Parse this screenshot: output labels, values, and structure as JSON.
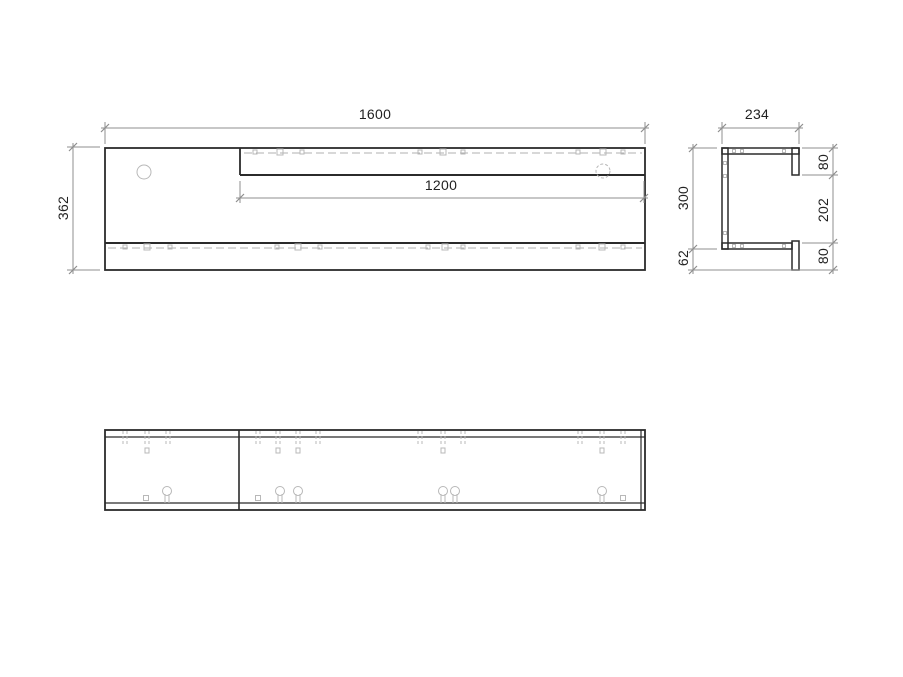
{
  "drawing_title": "furniture-panel-technical-drawing",
  "dimensions": {
    "front_width": {
      "value": "1600"
    },
    "shelf_length": {
      "value": "1200"
    },
    "front_height": {
      "value": "362"
    },
    "side_depth": {
      "value": "234"
    },
    "side_back_height": {
      "value": "300"
    },
    "side_bottom_drop": {
      "value": "62"
    },
    "side_top_lip": {
      "value": "80"
    },
    "side_opening": {
      "value": "202"
    },
    "side_bottom_lip": {
      "value": "80"
    }
  },
  "style": {
    "outline": "#2b2b2b",
    "dim": "#8f8f8f",
    "hidden": "#b0b0b0",
    "symbol": "#b8b8b8",
    "text": "#222222",
    "background": "#ffffff"
  },
  "shapes": [
    {
      "t": "rect",
      "x": 105,
      "y": 148,
      "w": 540,
      "h": 122,
      "sw": 1.8,
      "n": "front-view-outline"
    },
    {
      "t": "line",
      "x1": 240,
      "y1": 148,
      "x2": 240,
      "y2": 175,
      "w": 1.8,
      "n": "front-shelf-left-edge"
    },
    {
      "t": "line",
      "x1": 240,
      "y1": 175,
      "x2": 645,
      "y2": 175,
      "w": 2,
      "n": "front-shelf-bottom-edge"
    },
    {
      "t": "line",
      "x1": 105,
      "y1": 243,
      "x2": 645,
      "y2": 243,
      "w": 2,
      "n": "front-bottom-lip-top-edge"
    },
    {
      "t": "line",
      "x1": 244,
      "y1": 153,
      "x2": 642,
      "y2": 153,
      "w": 1,
      "c": "hidden",
      "dash": "8,4",
      "n": "front-shelf-hidden-line"
    },
    {
      "t": "line",
      "x1": 108,
      "y1": 248,
      "x2": 642,
      "y2": 248,
      "w": 1,
      "c": "hidden",
      "dash": "8,4",
      "n": "front-bottom-hidden-line"
    },
    {
      "t": "circle",
      "x": 144,
      "y": 172,
      "r": 7,
      "c": "sym",
      "n": "front-hole"
    },
    {
      "t": "circle",
      "x": 603,
      "y": 171,
      "r": 7,
      "c": "sym",
      "dash": "3,2",
      "n": "front-hidden-hole"
    },
    {
      "t": "sq",
      "x": 255,
      "y": 152,
      "s": 4
    },
    {
      "t": "sq",
      "x": 280,
      "y": 152,
      "s": 6
    },
    {
      "t": "sq",
      "x": 302,
      "y": 152,
      "s": 4
    },
    {
      "t": "sq",
      "x": 420,
      "y": 152,
      "s": 4
    },
    {
      "t": "sq",
      "x": 443,
      "y": 152,
      "s": 6
    },
    {
      "t": "sq",
      "x": 463,
      "y": 152,
      "s": 4
    },
    {
      "t": "sq",
      "x": 578,
      "y": 152,
      "s": 4
    },
    {
      "t": "sq",
      "x": 603,
      "y": 152,
      "s": 6
    },
    {
      "t": "sq",
      "x": 623,
      "y": 152,
      "s": 4
    },
    {
      "t": "sq",
      "x": 125,
      "y": 247,
      "s": 4
    },
    {
      "t": "sq",
      "x": 147,
      "y": 247,
      "s": 6
    },
    {
      "t": "sq",
      "x": 170,
      "y": 247,
      "s": 4
    },
    {
      "t": "sq",
      "x": 277,
      "y": 247,
      "s": 4
    },
    {
      "t": "sq",
      "x": 298,
      "y": 247,
      "s": 6
    },
    {
      "t": "sq",
      "x": 320,
      "y": 247,
      "s": 4
    },
    {
      "t": "sq",
      "x": 428,
      "y": 247,
      "s": 4
    },
    {
      "t": "sq",
      "x": 445,
      "y": 247,
      "s": 6
    },
    {
      "t": "sq",
      "x": 463,
      "y": 247,
      "s": 4
    },
    {
      "t": "sq",
      "x": 578,
      "y": 247,
      "s": 4
    },
    {
      "t": "sq",
      "x": 602,
      "y": 247,
      "s": 6
    },
    {
      "t": "sq",
      "x": 623,
      "y": 247,
      "s": 4
    },
    {
      "t": "line",
      "x1": 105,
      "y1": 144,
      "x2": 105,
      "y2": 122,
      "c": "dim",
      "n": "ext-line"
    },
    {
      "t": "line",
      "x1": 645,
      "y1": 144,
      "x2": 645,
      "y2": 122,
      "c": "dim",
      "n": "ext-line"
    },
    {
      "t": "line",
      "x1": 101,
      "y1": 128,
      "x2": 649,
      "y2": 128,
      "c": "dim",
      "n": "dim-line-front-width"
    },
    {
      "t": "tick",
      "x": 105,
      "y": 128
    },
    {
      "t": "tick",
      "x": 645,
      "y": 128
    },
    {
      "t": "line",
      "x1": 240,
      "y1": 181,
      "x2": 240,
      "y2": 203,
      "c": "dim",
      "n": "ext-line"
    },
    {
      "t": "line",
      "x1": 644,
      "y1": 181,
      "x2": 644,
      "y2": 203,
      "c": "dim",
      "n": "ext-line"
    },
    {
      "t": "line",
      "x1": 236,
      "y1": 198,
      "x2": 648,
      "y2": 198,
      "c": "dim",
      "n": "dim-line-shelf-length"
    },
    {
      "t": "tick",
      "x": 240,
      "y": 198
    },
    {
      "t": "tick",
      "x": 644,
      "y": 198
    },
    {
      "t": "line",
      "x1": 100,
      "y1": 147,
      "x2": 67,
      "y2": 147,
      "c": "dim",
      "n": "ext-line"
    },
    {
      "t": "line",
      "x1": 100,
      "y1": 270,
      "x2": 67,
      "y2": 270,
      "c": "dim",
      "n": "ext-line"
    },
    {
      "t": "line",
      "x1": 73,
      "y1": 143,
      "x2": 73,
      "y2": 274,
      "c": "dim",
      "n": "dim-line-front-height"
    },
    {
      "t": "tick",
      "x": 73,
      "y": 147
    },
    {
      "t": "tick",
      "x": 73,
      "y": 270
    },
    {
      "t": "rect",
      "x": 722,
      "y": 148,
      "w": 77,
      "h": 6,
      "sw": 1.5,
      "n": "side-top-panel"
    },
    {
      "t": "rect",
      "x": 792,
      "y": 148,
      "w": 7,
      "h": 27,
      "sw": 1.5,
      "n": "side-top-lip"
    },
    {
      "t": "rect",
      "x": 722,
      "y": 148,
      "w": 6,
      "h": 101,
      "sw": 1.5,
      "n": "side-back-panel"
    },
    {
      "t": "rect",
      "x": 722,
      "y": 243,
      "w": 70,
      "h": 6,
      "sw": 1.5,
      "n": "side-bottom-panel"
    },
    {
      "t": "rect",
      "x": 792,
      "y": 241,
      "w": 7,
      "h": 29,
      "sw": 1.5,
      "n": "side-bottom-lip"
    },
    {
      "t": "sq",
      "x": 734,
      "y": 151,
      "s": 3
    },
    {
      "t": "sq",
      "x": 742,
      "y": 151,
      "s": 3
    },
    {
      "t": "sq",
      "x": 784,
      "y": 151,
      "s": 3
    },
    {
      "t": "sq",
      "x": 734,
      "y": 246,
      "s": 3
    },
    {
      "t": "sq",
      "x": 742,
      "y": 246,
      "s": 3
    },
    {
      "t": "sq",
      "x": 784,
      "y": 246,
      "s": 3
    },
    {
      "t": "sq",
      "x": 725,
      "y": 163,
      "s": 3
    },
    {
      "t": "sq",
      "x": 725,
      "y": 176,
      "s": 3
    },
    {
      "t": "sq",
      "x": 725,
      "y": 233,
      "s": 3
    },
    {
      "t": "line",
      "x1": 722,
      "y1": 144,
      "x2": 722,
      "y2": 122,
      "c": "dim",
      "n": "ext-line"
    },
    {
      "t": "line",
      "x1": 799,
      "y1": 144,
      "x2": 799,
      "y2": 122,
      "c": "dim",
      "n": "ext-line"
    },
    {
      "t": "line",
      "x1": 718,
      "y1": 128,
      "x2": 803,
      "y2": 128,
      "c": "dim",
      "n": "dim-line-side-depth"
    },
    {
      "t": "tick",
      "x": 722,
      "y": 128
    },
    {
      "t": "tick",
      "x": 799,
      "y": 128
    },
    {
      "t": "line",
      "x1": 717,
      "y1": 148,
      "x2": 688,
      "y2": 148,
      "c": "dim",
      "n": "ext-line"
    },
    {
      "t": "line",
      "x1": 717,
      "y1": 249,
      "x2": 688,
      "y2": 249,
      "c": "dim",
      "n": "ext-line"
    },
    {
      "t": "line",
      "x1": 838,
      "y1": 270,
      "x2": 688,
      "y2": 270,
      "c": "dim",
      "n": "ext-line"
    },
    {
      "t": "line",
      "x1": 693,
      "y1": 144,
      "x2": 693,
      "y2": 274,
      "c": "dim",
      "n": "dim-line-side-height"
    },
    {
      "t": "tick",
      "x": 693,
      "y": 148
    },
    {
      "t": "tick",
      "x": 693,
      "y": 249
    },
    {
      "t": "tick",
      "x": 693,
      "y": 270
    },
    {
      "t": "line",
      "x1": 802,
      "y1": 148,
      "x2": 838,
      "y2": 148,
      "c": "dim",
      "n": "ext-line"
    },
    {
      "t": "line",
      "x1": 802,
      "y1": 175,
      "x2": 838,
      "y2": 175,
      "c": "dim",
      "n": "ext-line"
    },
    {
      "t": "line",
      "x1": 802,
      "y1": 243,
      "x2": 838,
      "y2": 243,
      "c": "dim",
      "n": "ext-line"
    },
    {
      "t": "line",
      "x1": 833,
      "y1": 144,
      "x2": 833,
      "y2": 274,
      "c": "dim",
      "n": "dim-line-side-right"
    },
    {
      "t": "tick",
      "x": 833,
      "y": 148
    },
    {
      "t": "tick",
      "x": 833,
      "y": 175
    },
    {
      "t": "tick",
      "x": 833,
      "y": 243
    },
    {
      "t": "tick",
      "x": 833,
      "y": 270
    },
    {
      "t": "rect",
      "x": 105,
      "y": 430,
      "w": 540,
      "h": 80,
      "sw": 1.8,
      "n": "top-view-outline"
    },
    {
      "t": "line",
      "x1": 105,
      "y1": 437,
      "x2": 645,
      "y2": 437,
      "w": 1.2,
      "n": "top-view-back-edge"
    },
    {
      "t": "line",
      "x1": 105,
      "y1": 503,
      "x2": 645,
      "y2": 503,
      "w": 1.2,
      "n": "top-view-front-edge"
    },
    {
      "t": "line",
      "x1": 641,
      "y1": 430,
      "x2": 641,
      "y2": 510,
      "w": 1.2,
      "n": "top-view-right-inner-edge"
    },
    {
      "t": "line",
      "x1": 239,
      "y1": 430,
      "x2": 239,
      "y2": 510,
      "w": 1.6,
      "n": "top-view-divider"
    },
    {
      "t": "pair",
      "x": 125
    },
    {
      "t": "pair",
      "x": 147,
      "deep": true
    },
    {
      "t": "pair",
      "x": 168
    },
    {
      "t": "pair",
      "x": 258
    },
    {
      "t": "pair",
      "x": 278,
      "deep": true
    },
    {
      "t": "pair",
      "x": 298,
      "deep": true
    },
    {
      "t": "pair",
      "x": 318
    },
    {
      "t": "pair",
      "x": 420
    },
    {
      "t": "pair",
      "x": 443,
      "deep": true
    },
    {
      "t": "pair",
      "x": 463
    },
    {
      "t": "pair",
      "x": 580
    },
    {
      "t": "pair",
      "x": 602,
      "deep": true
    },
    {
      "t": "pair",
      "x": 623
    },
    {
      "t": "keyhole",
      "x": 167
    },
    {
      "t": "keyhole",
      "x": 280
    },
    {
      "t": "keyhole",
      "x": 298
    },
    {
      "t": "keyhole",
      "x": 443
    },
    {
      "t": "keyhole",
      "x": 455
    },
    {
      "t": "keyhole",
      "x": 602
    },
    {
      "t": "sq",
      "x": 146,
      "y": 498,
      "s": 5
    },
    {
      "t": "sq",
      "x": 258,
      "y": 498,
      "s": 5
    },
    {
      "t": "sq",
      "x": 623,
      "y": 498,
      "s": 5
    }
  ]
}
